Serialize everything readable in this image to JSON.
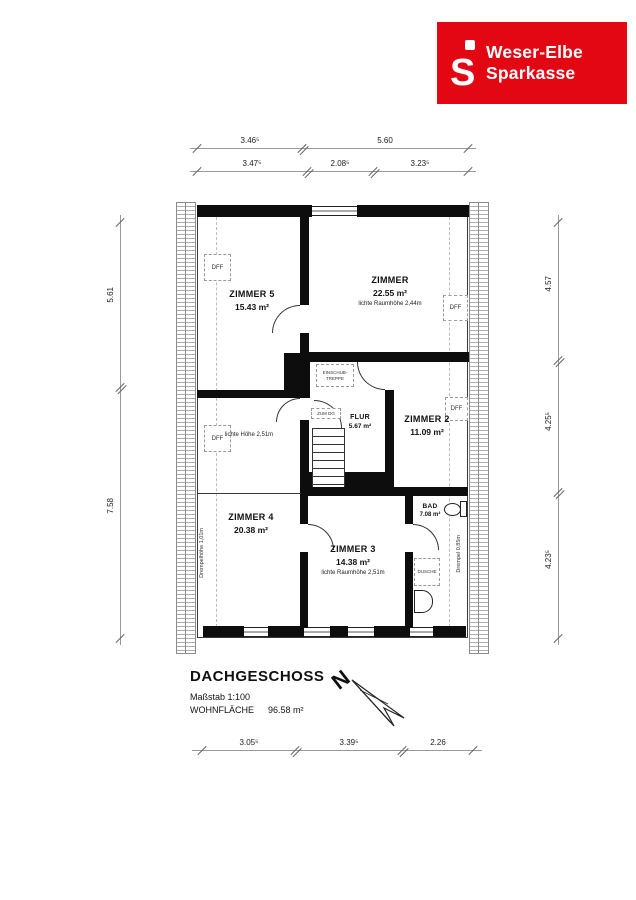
{
  "logo": {
    "icon_letter": "S",
    "line1": "Weser-Elbe",
    "line2": "Sparkasse",
    "brand_color": "#e30613"
  },
  "plan": {
    "rooms": {
      "zimmer5": {
        "name": "ZIMMER 5",
        "area": "15.43 m²"
      },
      "zimmer": {
        "name": "ZIMMER",
        "area": "22.55 m²",
        "note": "lichte Raumhöhe 2,44m"
      },
      "zimmer2": {
        "name": "ZIMMER 2",
        "area": "11.09 m²"
      },
      "zimmer3": {
        "name": "ZIMMER 3",
        "area": "14.38 m²",
        "note": "lichte Raumhöhe 2,51m"
      },
      "zimmer4": {
        "name": "ZIMMER 4",
        "area": "20.38 m²"
      },
      "flur": {
        "name": "FLUR",
        "area": "5.67 m²"
      },
      "bad": {
        "name": "BAD",
        "area": "7.08 m²"
      }
    },
    "annotations": {
      "dff": "DFF",
      "einschub_line1": "EINSCHUB-",
      "einschub_line2": "TREPPE",
      "zum_dg": "ZUM DG",
      "dusche": "DUSCHE",
      "lichte_hoehe": "lichte Höhe 2,51m",
      "drempel_left": "Drempelhöhe 1,01m",
      "drempel_right": "Drempel 0,85m"
    }
  },
  "dimensions": {
    "top_row1": [
      "3.46⁵",
      "5.60"
    ],
    "top_row2": [
      "3.47⁵",
      "2.08⁵",
      "3.23⁵"
    ],
    "left": [
      "5.61",
      "7.58"
    ],
    "right": [
      "4.57",
      "4.25⁵",
      "4.23⁵"
    ],
    "bottom": [
      "3.05⁵",
      "3.39⁵",
      "2.26"
    ]
  },
  "title_block": {
    "title": "DACHGESCHOSS",
    "scale": "Maßstab 1:100",
    "area_label": "WOHNFLÄCHE",
    "area_value": "96.58 m²",
    "north": "N"
  }
}
